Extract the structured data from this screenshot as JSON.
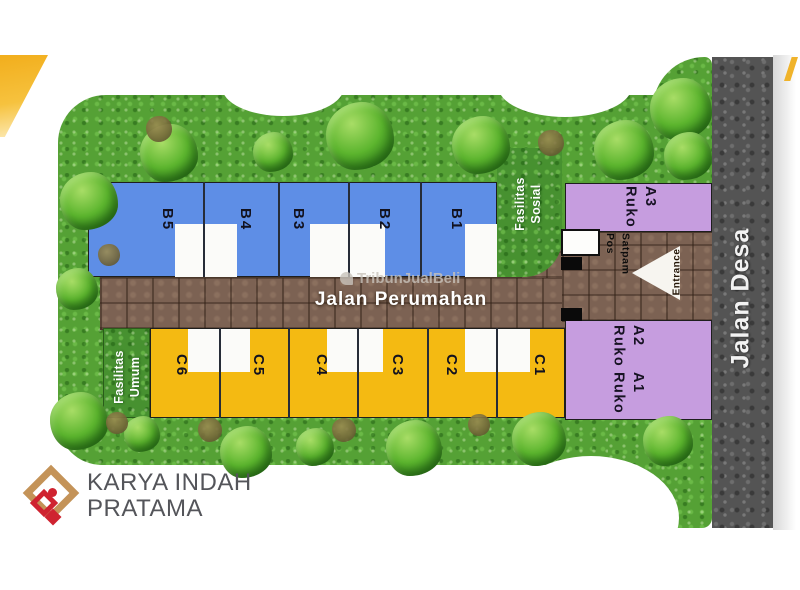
{
  "plan": {
    "row_b": [
      "B5",
      "B4",
      "B3",
      "B2",
      "B1"
    ],
    "row_c": [
      "C6",
      "C5",
      "C4",
      "C3",
      "C2",
      "C1"
    ],
    "ruko": [
      {
        "name": "Ruko",
        "unit": "A3"
      },
      {
        "name": "Ruko",
        "unit": "A2"
      },
      {
        "name": "Ruko",
        "unit": "A1"
      }
    ],
    "roads": {
      "main": "Jalan Perumahan",
      "village": "Jalan Desa"
    },
    "entrance": "Entrance",
    "guard_post": {
      "line1": "Pos",
      "line2": "Satpam"
    },
    "social_facility": {
      "line1": "Fasilitas",
      "line2": "Sosial"
    },
    "public_facility": {
      "line1": "Fasilitas",
      "line2": "Umum"
    },
    "watermark": "TribunJualBeli",
    "brand": {
      "line1": "KARYA INDAH",
      "line2": "PRATAMA"
    },
    "colors": {
      "block_b_blue": "#5e8ee6",
      "block_c_yellow": "#f4ba12",
      "ruko_purple": "#c69ddf",
      "road_brown": "#7c6253",
      "road_gray": "#545454",
      "grass_green": "#55a135",
      "accent_yellow": "#f2ae1c",
      "logo_gold": "#c49358",
      "logo_red": "#cf2330"
    }
  }
}
